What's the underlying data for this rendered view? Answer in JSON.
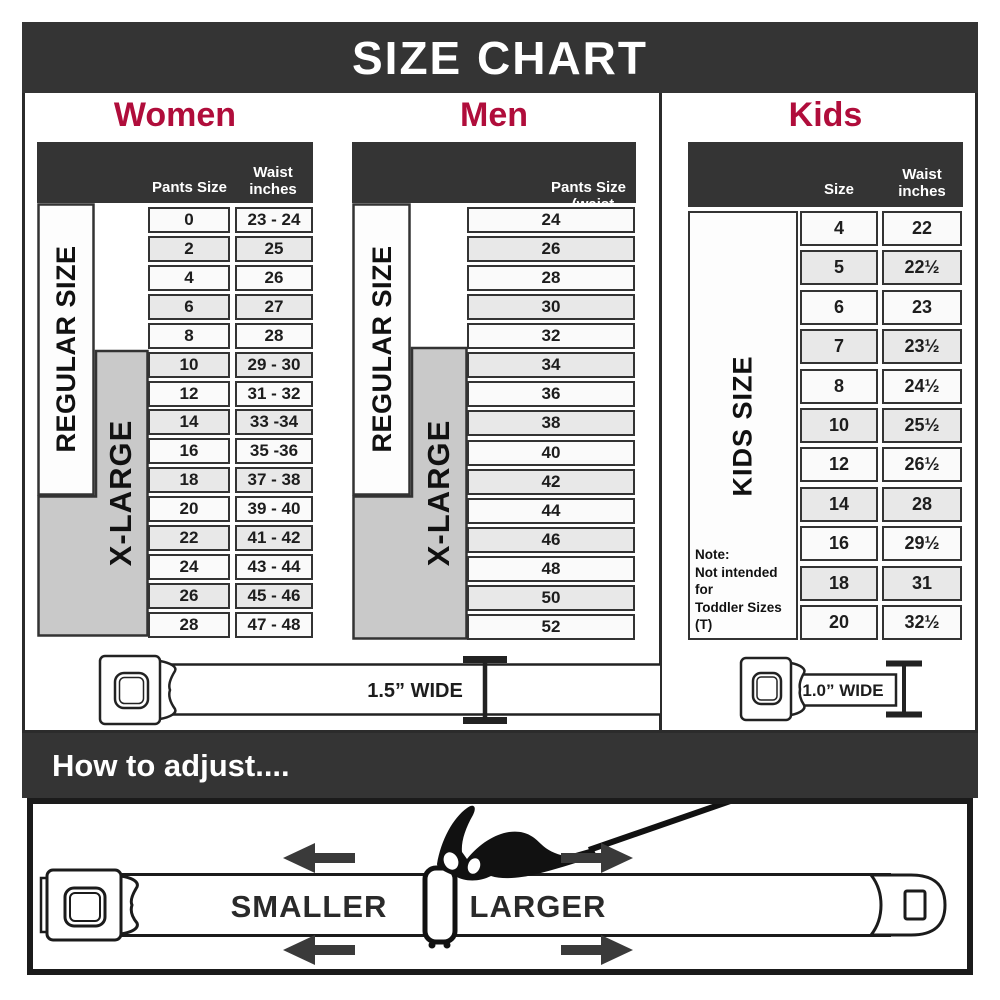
{
  "title": "SIZE CHART",
  "colors": {
    "accent": "#B00D3B",
    "dark": "#343434",
    "gray_block": "#c9c9c9"
  },
  "women": {
    "heading": "Women",
    "col1_header": "Pants Size",
    "col2_header": "Waist inches",
    "regular_label": "REGULAR SIZE",
    "xlarge_label": "X-LARGE",
    "rows": [
      {
        "size": "0",
        "waist": "23 - 24"
      },
      {
        "size": "2",
        "waist": "25"
      },
      {
        "size": "4",
        "waist": "26"
      },
      {
        "size": "6",
        "waist": "27"
      },
      {
        "size": "8",
        "waist": "28"
      },
      {
        "size": "10",
        "waist": "29 - 30"
      },
      {
        "size": "12",
        "waist": "31 - 32"
      },
      {
        "size": "14",
        "waist": "33 -34"
      },
      {
        "size": "16",
        "waist": "35 -36"
      },
      {
        "size": "18",
        "waist": "37 - 38"
      },
      {
        "size": "20",
        "waist": "39 - 40"
      },
      {
        "size": "22",
        "waist": "41 - 42"
      },
      {
        "size": "24",
        "waist": "43 - 44"
      },
      {
        "size": "26",
        "waist": "45 - 46"
      },
      {
        "size": "28",
        "waist": "47 - 48"
      }
    ]
  },
  "men": {
    "heading": "Men",
    "header_line1": "Pants Size",
    "header_line2": "(waist inches)",
    "regular_label": "REGULAR SIZE",
    "xlarge_label": "X-LARGE",
    "rows": [
      "24",
      "26",
      "28",
      "30",
      "32",
      "34",
      "36",
      "38",
      "40",
      "42",
      "44",
      "46",
      "48",
      "50",
      "52"
    ]
  },
  "kids": {
    "heading": "Kids",
    "col1_header": "Size",
    "col2_header": "Waist inches",
    "side_label": "KIDS SIZE",
    "note_title": "Note:",
    "note_line1": "Not intended for",
    "note_line2": "Toddler Sizes (T)",
    "rows": [
      {
        "size": "4",
        "waist": "22"
      },
      {
        "size": "5",
        "waist": "22½"
      },
      {
        "size": "6",
        "waist": "23"
      },
      {
        "size": "7",
        "waist": "23½"
      },
      {
        "size": "8",
        "waist": "24½"
      },
      {
        "size": "10",
        "waist": "25½"
      },
      {
        "size": "12",
        "waist": "26½"
      },
      {
        "size": "14",
        "waist": "28"
      },
      {
        "size": "16",
        "waist": "29½"
      },
      {
        "size": "18",
        "waist": "31"
      },
      {
        "size": "20",
        "waist": "32½"
      }
    ]
  },
  "belts": {
    "adult_width_label": "1.5” WIDE",
    "kids_width_label": "1.0” WIDE"
  },
  "adjust": {
    "heading": "How to adjust....",
    "smaller_label": "SMALLER",
    "larger_label": "LARGER"
  }
}
